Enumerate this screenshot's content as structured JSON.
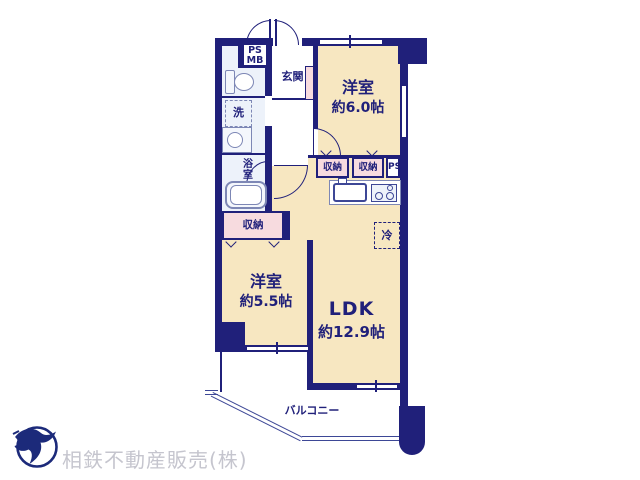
{
  "colors": {
    "wall": "#20207a",
    "room_fill": "#f7e7c1",
    "closet_fill": "#f7dbdf",
    "wet_fill": "#edf2fa",
    "fixture_line": "#7d87b5",
    "thin_line": "#3d4796",
    "footer_text": "#c5c5ce"
  },
  "rooms": {
    "bedroom6": {
      "name": "洋室",
      "size": "約6.0帖"
    },
    "bedroom55": {
      "name": "洋室",
      "size": "約5.5帖"
    },
    "ldk": {
      "name": "LDK",
      "size": "約12.9帖"
    },
    "entrance": {
      "name": "玄関"
    },
    "balcony": {
      "name": "バルコニー"
    },
    "bathroom": {
      "name": "浴室"
    }
  },
  "labels": {
    "storage": "収納",
    "washer": "洗",
    "refrigerator": "冷",
    "ps": "PS",
    "mb": "MB"
  },
  "footer": {
    "company": "相鉄不動産販売(株)",
    "logo": "sotetsu-bird-logo"
  }
}
